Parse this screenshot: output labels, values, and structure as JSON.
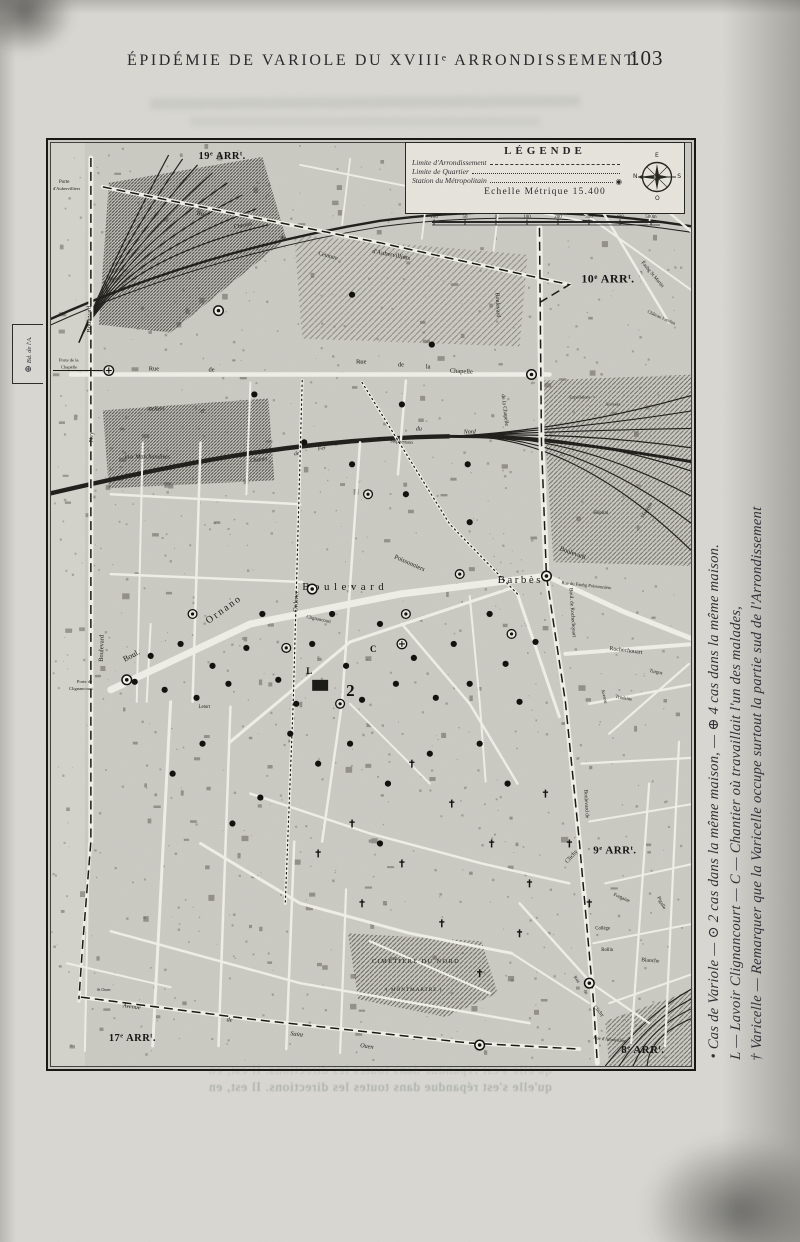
{
  "page": {
    "header_title": "ÉPIDÉMIE DE VARIOLE DU XVIIIᵉ ARRONDISSEMENT.",
    "page_number": "103",
    "showthrough_text": "qu'elle s'est répandue dans toutes les directions. Il est, en"
  },
  "side_note": {
    "lines": [
      "• Cas de Variole — ⊙ 2 cas dans la même maison, — ⊕ 4 cas dans la même maison.",
      "L — Lavoir Clignancourt — C — Chantier où travaillait l'un des malades,",
      "† Varicelle — Remarquer que la Varicelle occupe surtout la partie sud de l'Arrondissement"
    ]
  },
  "legend": {
    "title": "LÉGENDE",
    "items": [
      {
        "label": "Limite d'Arrondissement",
        "line": "dashed"
      },
      {
        "label": "Limite de Quartier",
        "line": "dotted"
      },
      {
        "label": "Station du Métropolitain",
        "line": "dotted",
        "symbol": "◉"
      }
    ],
    "scale_label": "Echelle Métrique 15.400",
    "scale_ticks": [
      "100",
      "50",
      "0",
      "100",
      "200",
      "300",
      "400",
      "500m"
    ],
    "compass": {
      "n": "N",
      "e": "E",
      "s": "S",
      "o": "O"
    }
  },
  "map": {
    "frame_tab": {
      "symbol": "⊕",
      "label": "Bd. de l'A."
    },
    "arr_labels": [
      {
        "t": "19e ARRt",
        "x": 148,
        "y": 16,
        "s": 10.5
      },
      {
        "t": "10e ARRt",
        "x": 532,
        "y": 140,
        "s": 12
      },
      {
        "t": "9e ARRt",
        "x": 544,
        "y": 712,
        "s": 11
      },
      {
        "t": "8e ARRt",
        "x": 572,
        "y": 912,
        "s": 11
      },
      {
        "t": "17e ARRt",
        "x": 58,
        "y": 900,
        "s": 10.5
      }
    ],
    "labels": [
      {
        "t": "Porte",
        "x": 8,
        "y": 40,
        "s": 5
      },
      {
        "t": "d'Aubervilliers",
        "x": 2,
        "y": 47,
        "s": 4.6
      },
      {
        "t": "Rue",
        "x": 146,
        "y": 72,
        "s": 6.5,
        "r": 9
      },
      {
        "t": "d'Aubervilliers",
        "x": 322,
        "y": 110,
        "s": 6.5,
        "r": 11
      },
      {
        "t": "Service Municipal",
        "x": 440,
        "y": 30,
        "s": 4.6
      },
      {
        "t": "des",
        "x": 466,
        "y": 41,
        "s": 4.6
      },
      {
        "t": "Pompes Funèbres",
        "x": 442,
        "y": 52,
        "s": 4.6
      },
      {
        "t": "Chemin",
        "x": 184,
        "y": 86,
        "s": 5.8,
        "r": -12
      },
      {
        "t": "de",
        "x": 230,
        "y": 96,
        "s": 5.8,
        "r": 6
      },
      {
        "t": "Ceinture",
        "x": 268,
        "y": 112,
        "s": 5.8,
        "r": 15
      },
      {
        "t": "Porte de la",
        "x": 8,
        "y": 219,
        "s": 4.6
      },
      {
        "t": "Chapelle",
        "x": 10,
        "y": 226,
        "s": 4.6
      },
      {
        "t": "Rue",
        "x": 98,
        "y": 228,
        "s": 6.5
      },
      {
        "t": "de",
        "x": 158,
        "y": 229,
        "s": 6.5
      },
      {
        "t": "Rue",
        "x": 306,
        "y": 221,
        "s": 6.5
      },
      {
        "t": "de",
        "x": 348,
        "y": 224,
        "s": 6.5
      },
      {
        "t": "la",
        "x": 376,
        "y": 226,
        "s": 6.5
      },
      {
        "t": "Chapelle",
        "x": 400,
        "y": 230,
        "s": 6.5,
        "r": 3
      },
      {
        "t": "Ateliers",
        "x": 96,
        "y": 268,
        "s": 5.8,
        "i": 1
      },
      {
        "t": "et",
        "x": 150,
        "y": 270,
        "s": 5.8,
        "i": 1
      },
      {
        "t": "aux Marchandises",
        "x": 74,
        "y": 316,
        "s": 6.2,
        "i": 1
      },
      {
        "t": "Chemin",
        "x": 200,
        "y": 320,
        "s": 5.5,
        "r": -8,
        "i": 1
      },
      {
        "t": "de",
        "x": 244,
        "y": 313,
        "s": 5.5,
        "r": -8,
        "i": 1
      },
      {
        "t": "Fer",
        "x": 268,
        "y": 308,
        "s": 5.5,
        "r": -8,
        "i": 1
      },
      {
        "t": "du",
        "x": 366,
        "y": 288,
        "s": 6,
        "i": 1
      },
      {
        "t": "Nord",
        "x": 414,
        "y": 291,
        "s": 6,
        "i": 1
      },
      {
        "t": "Stephenson",
        "x": 340,
        "y": 300,
        "s": 5,
        "r": 4
      },
      {
        "t": "Expéditions",
        "x": 520,
        "y": 256,
        "s": 4.4
      },
      {
        "t": "Arrivées",
        "x": 556,
        "y": 263,
        "s": 4.4
      },
      {
        "t": "Boulevard",
        "x": 446,
        "y": 150,
        "s": 6,
        "r": 87
      },
      {
        "t": "de la Chapelle",
        "x": 452,
        "y": 252,
        "s": 5.6,
        "r": 83
      },
      {
        "t": "Faubg St Martin",
        "x": 592,
        "y": 120,
        "s": 5,
        "r": 50
      },
      {
        "t": "Château Landon",
        "x": 598,
        "y": 170,
        "s": 4.6,
        "r": 24
      },
      {
        "t": "Riquet",
        "x": 606,
        "y": 58,
        "s": 5,
        "r": -72
      },
      {
        "t": "Hôpital",
        "x": 544,
        "y": 372,
        "s": 5
      },
      {
        "t": "Magenta",
        "x": 594,
        "y": 376,
        "s": 5,
        "r": -58
      },
      {
        "t": "Boulevard",
        "x": 252,
        "y": 448,
        "s": 11,
        "sp": 4.5
      },
      {
        "t": "Barbès",
        "x": 448,
        "y": 441,
        "s": 11,
        "sp": 2.5
      },
      {
        "t": "Ornano",
        "x": 158,
        "y": 482,
        "s": 10,
        "r": -36,
        "sp": 2
      },
      {
        "t": "Boul.",
        "x": 74,
        "y": 520,
        "s": 8,
        "r": -28
      },
      {
        "t": "Ordener",
        "x": 247,
        "y": 470,
        "s": 6.5,
        "r": -87
      },
      {
        "t": "Poissonniers",
        "x": 344,
        "y": 416,
        "s": 6.5,
        "r": 24
      },
      {
        "t": "Clignancourt",
        "x": 256,
        "y": 476,
        "s": 4.8,
        "r": 12
      },
      {
        "t": "Letort",
        "x": 148,
        "y": 566,
        "s": 4.8
      },
      {
        "t": "Porte de",
        "x": 26,
        "y": 541,
        "s": 4.6
      },
      {
        "t": "Clignancourt",
        "x": 18,
        "y": 548,
        "s": 4.6
      },
      {
        "t": "Boulevard",
        "x": 40,
        "y": 190,
        "s": 6.5,
        "r": -90
      },
      {
        "t": "Ney",
        "x": 42,
        "y": 300,
        "s": 6.5,
        "r": -90
      },
      {
        "t": "Boulevard",
        "x": 52,
        "y": 520,
        "s": 6.5,
        "r": -88
      },
      {
        "t": "Boulevard",
        "x": 510,
        "y": 408,
        "s": 6.5,
        "r": 20
      },
      {
        "t": "Rue du Faubg Poissonnière",
        "x": 512,
        "y": 442,
        "s": 4.6,
        "r": 6
      },
      {
        "t": "Rochechouart",
        "x": 560,
        "y": 508,
        "s": 6,
        "r": 7
      },
      {
        "t": "Boul. de Rochechouart",
        "x": 520,
        "y": 446,
        "s": 5.4,
        "r": 86
      },
      {
        "t": "Boulevard de",
        "x": 535,
        "y": 648,
        "s": 5.4,
        "r": 87
      },
      {
        "t": "Clichy",
        "x": 518,
        "y": 722,
        "s": 6,
        "r": -48
      },
      {
        "t": "Avenue",
        "x": 552,
        "y": 548,
        "s": 4.8,
        "r": 76
      },
      {
        "t": "Trudaine",
        "x": 566,
        "y": 556,
        "s": 4.8,
        "r": 10
      },
      {
        "t": "Turgot",
        "x": 600,
        "y": 530,
        "s": 5,
        "r": 12
      },
      {
        "t": "Collège",
        "x": 546,
        "y": 788,
        "s": 4.8
      },
      {
        "t": "Rollin",
        "x": 552,
        "y": 810,
        "s": 4.8
      },
      {
        "t": "Fontaine",
        "x": 564,
        "y": 754,
        "s": 5,
        "r": 24
      },
      {
        "t": "Pigalle",
        "x": 608,
        "y": 756,
        "s": 5,
        "r": 62
      },
      {
        "t": "Blanche",
        "x": 592,
        "y": 820,
        "s": 5.6,
        "r": 4
      },
      {
        "t": "Rue",
        "x": 524,
        "y": 836,
        "s": 4.8,
        "r": 52
      },
      {
        "t": "de",
        "x": 534,
        "y": 850,
        "s": 4.8,
        "r": 52
      },
      {
        "t": "Clichy",
        "x": 544,
        "y": 866,
        "s": 5,
        "r": 48
      },
      {
        "t": "Rue d'Amsterdam",
        "x": 544,
        "y": 898,
        "s": 4.6,
        "r": 6
      },
      {
        "t": "Avenue",
        "x": 72,
        "y": 866,
        "s": 6.2,
        "r": 7,
        "i": 1
      },
      {
        "t": "de",
        "x": 176,
        "y": 880,
        "s": 6.2,
        "r": 7,
        "i": 1
      },
      {
        "t": "Saint",
        "x": 240,
        "y": 894,
        "s": 6.2,
        "r": 8,
        "i": 1
      },
      {
        "t": "Ouen",
        "x": 310,
        "y": 906,
        "s": 6.2,
        "r": 8,
        "i": 1
      },
      {
        "t": "St Ouen",
        "x": 46,
        "y": 850,
        "s": 4.2
      },
      {
        "t": "CIMETIÈRE DU NORD",
        "x": 322,
        "y": 822,
        "s": 6.4,
        "sp": 1.4
      },
      {
        "t": "( MONTMARTRE )",
        "x": 336,
        "y": 850,
        "s": 5.2,
        "sp": 1
      }
    ],
    "case_dots": [
      [
        84,
        540
      ],
      [
        100,
        514
      ],
      [
        114,
        548
      ],
      [
        130,
        502
      ],
      [
        146,
        556
      ],
      [
        162,
        524
      ],
      [
        178,
        542
      ],
      [
        196,
        506
      ],
      [
        212,
        472
      ],
      [
        228,
        538
      ],
      [
        246,
        562
      ],
      [
        262,
        502
      ],
      [
        282,
        472
      ],
      [
        296,
        524
      ],
      [
        312,
        558
      ],
      [
        330,
        482
      ],
      [
        346,
        542
      ],
      [
        364,
        516
      ],
      [
        386,
        556
      ],
      [
        404,
        502
      ],
      [
        420,
        542
      ],
      [
        440,
        472
      ],
      [
        456,
        522
      ],
      [
        470,
        560
      ],
      [
        486,
        500
      ],
      [
        300,
        602
      ],
      [
        268,
        622
      ],
      [
        338,
        642
      ],
      [
        380,
        612
      ],
      [
        240,
        592
      ],
      [
        152,
        602
      ],
      [
        122,
        632
      ],
      [
        430,
        602
      ],
      [
        458,
        642
      ],
      [
        210,
        656
      ],
      [
        182,
        682
      ],
      [
        330,
        702
      ],
      [
        254,
        300
      ],
      [
        302,
        322
      ],
      [
        352,
        262
      ],
      [
        418,
        322
      ],
      [
        382,
        202
      ],
      [
        302,
        152
      ],
      [
        204,
        252
      ],
      [
        356,
        352
      ],
      [
        420,
        380
      ]
    ],
    "double_cases": [
      [
        142,
        472
      ],
      [
        236,
        506
      ],
      [
        356,
        472
      ],
      [
        410,
        432
      ],
      [
        290,
        562
      ],
      [
        462,
        492
      ],
      [
        318,
        352
      ]
    ],
    "quad_cases": [
      [
        58,
        228
      ],
      [
        352,
        502
      ]
    ],
    "varicelle_marks": [
      [
        362,
        622
      ],
      [
        402,
        662
      ],
      [
        442,
        702
      ],
      [
        480,
        742
      ],
      [
        352,
        722
      ],
      [
        302,
        682
      ],
      [
        520,
        702
      ],
      [
        470,
        792
      ],
      [
        392,
        782
      ],
      [
        430,
        832
      ],
      [
        540,
        762
      ],
      [
        312,
        762
      ],
      [
        268,
        712
      ],
      [
        496,
        652
      ]
    ],
    "metro_stations": [
      [
        262,
        447
      ],
      [
        497,
        434
      ],
      [
        76,
        538
      ],
      [
        540,
        842
      ],
      [
        168,
        168
      ],
      [
        482,
        232
      ],
      [
        430,
        904
      ]
    ],
    "letters": [
      {
        "t": "L",
        "x": 256,
        "y": 532,
        "s": 9
      },
      {
        "t": "C",
        "x": 320,
        "y": 510,
        "s": 9
      },
      {
        "t": "2",
        "x": 296,
        "y": 554,
        "s": 17
      }
    ]
  }
}
